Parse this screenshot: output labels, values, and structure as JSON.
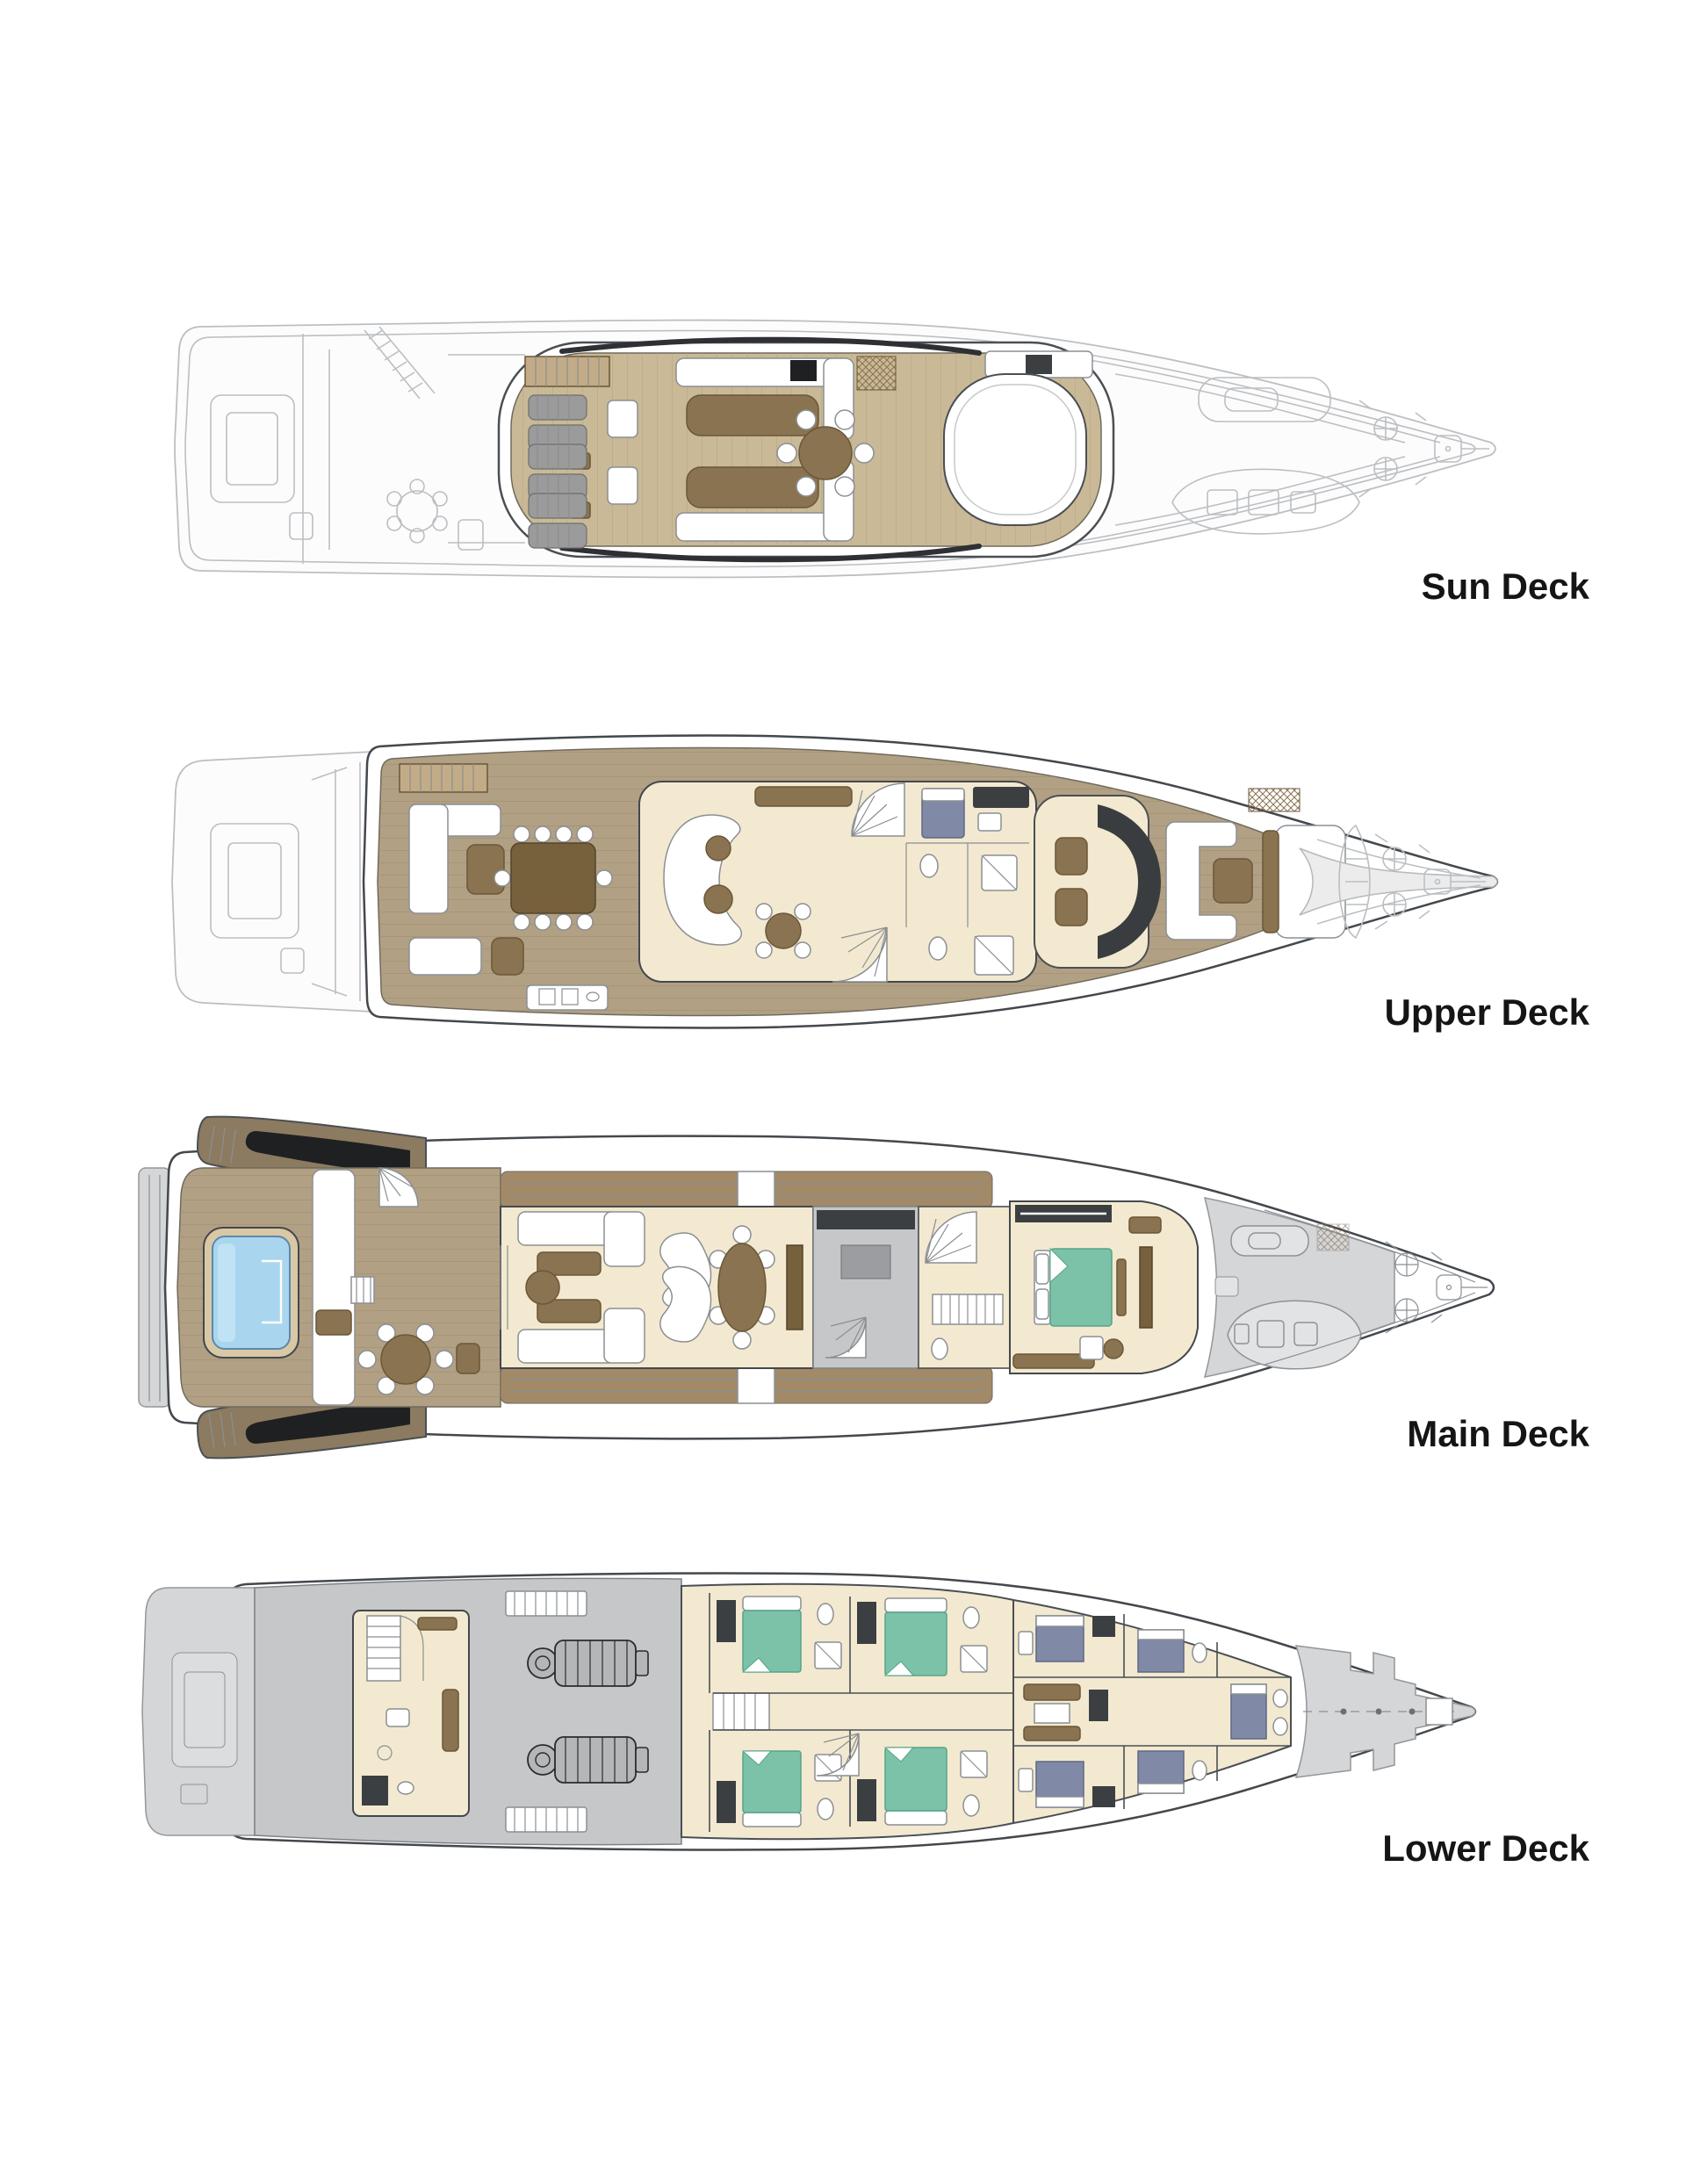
{
  "decks": [
    {
      "id": "sun-deck",
      "label": "Sun Deck"
    },
    {
      "id": "upper-deck",
      "label": "Upper Deck"
    },
    {
      "id": "main-deck",
      "label": "Main Deck"
    },
    {
      "id": "lower-deck",
      "label": "Lower Deck"
    }
  ],
  "colors": {
    "teak_light": "#c9b996",
    "teak_mid": "#b2a084",
    "teak_walkway": "#a28a68",
    "furniture_brown": "#8a7350",
    "table_dark": "#77603c",
    "interior_cream": "#f2e9d0",
    "pool_blue": "#a9d6ee",
    "bed_teal": "#7cc2a8",
    "crew_blue": "#8089a6",
    "ghost_gray": "#bcbfc2",
    "deck_gray": "#d5d6d8",
    "machinery_gray": "#c6c7c9",
    "dark_trim": "#43484d",
    "label_black": "#151515"
  }
}
